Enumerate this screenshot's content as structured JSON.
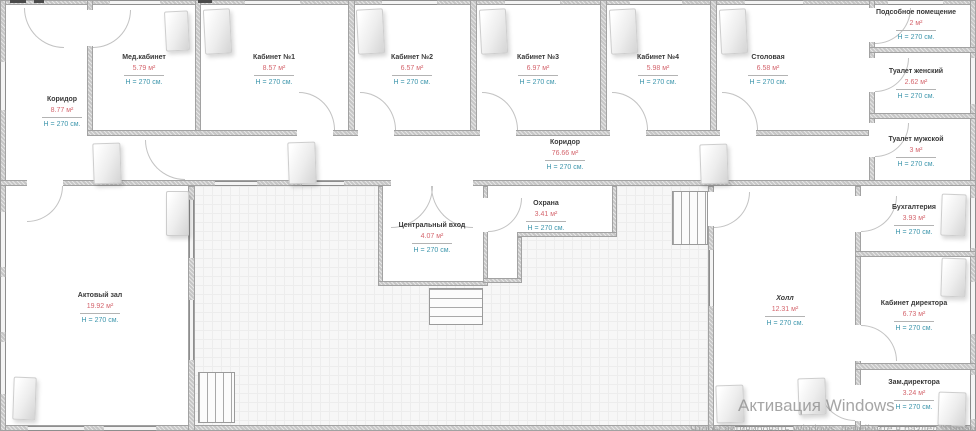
{
  "rooms": [
    {
      "name": "Коридор",
      "area": "8.77 м²",
      "height": "H = 270 см."
    },
    {
      "name": "Мед.кабинет",
      "area": "5.79 м²",
      "height": "H = 270 см."
    },
    {
      "name": "Кабинет №1",
      "area": "8.57 м²",
      "height": "H = 270 см."
    },
    {
      "name": "Кабинет №2",
      "area": "6.57 м²",
      "height": "H = 270 см."
    },
    {
      "name": "Кабинет №3",
      "area": "6.97 м²",
      "height": "H = 270 см."
    },
    {
      "name": "Кабинет №4",
      "area": "5.98 м²",
      "height": "H = 270 см."
    },
    {
      "name": "Столовая",
      "area": "6.58 м²",
      "height": "H = 270 см."
    },
    {
      "name": "Подсобное помещение",
      "area": "2 м²",
      "height": "H = 270 см."
    },
    {
      "name": "Туалет женский",
      "area": "2.62 м²",
      "height": "H = 270 см."
    },
    {
      "name": "Туалет мужской",
      "area": "3 м²",
      "height": "H = 270 см."
    },
    {
      "name": "Коридор",
      "area": "76.66 м²",
      "height": "H = 270 см."
    },
    {
      "name": "Актовый зал",
      "area": "19.92 м²",
      "height": "H = 270 см."
    },
    {
      "name": "Центральный вход",
      "area": "4.07 м²",
      "height": "H = 270 см."
    },
    {
      "name": "Охрана",
      "area": "3.41 м²",
      "height": "H = 270 см."
    },
    {
      "name": "Холл",
      "area": "12.31 м²",
      "height": "H = 270 см."
    },
    {
      "name": "Бухгалтерия",
      "area": "3.93 м²",
      "height": "H = 270 см."
    },
    {
      "name": "Кабинет директора",
      "area": "6.73 м²",
      "height": "H = 270 см."
    },
    {
      "name": "Зам.директора",
      "area": "3.24 м²",
      "height": "H = 270 см."
    }
  ],
  "watermark": {
    "line1": "Активация Windows",
    "line2": "Чтобы активировать Windows, перейдите в раздел \"Параметры\"."
  },
  "colors": {
    "wall": "#c6c6c6",
    "area_text": "#d4666e",
    "height_text": "#3d96ac",
    "room_name_text": "#3a3a3a"
  }
}
